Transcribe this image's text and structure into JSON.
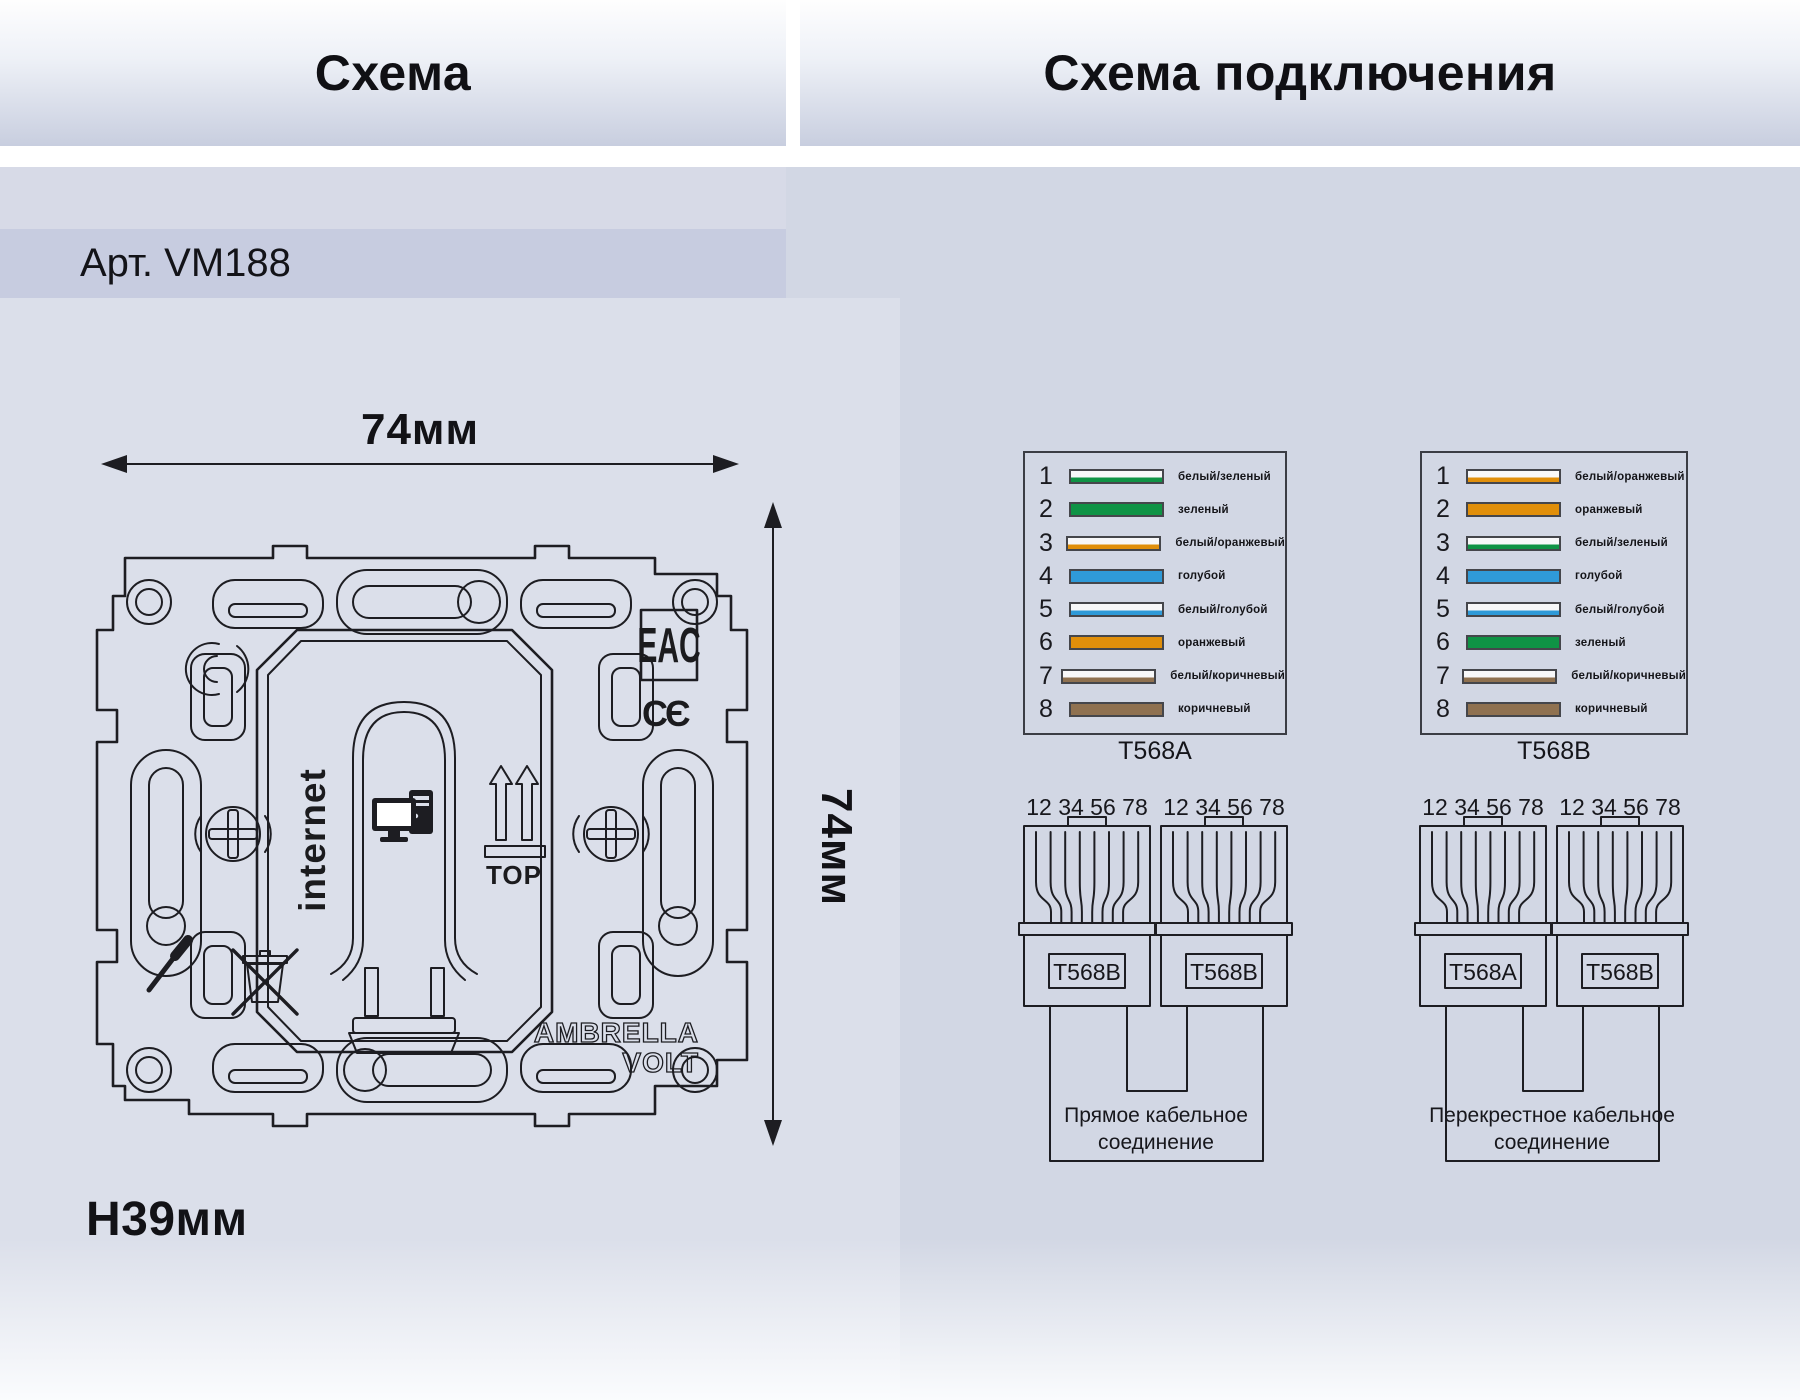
{
  "page": {
    "section_left_title": "Схема",
    "section_right_title": "Схема подключения",
    "article": "Арт. VM188"
  },
  "dimensions": {
    "width_label": "74мм",
    "height_label": "74мм",
    "depth_label": "H39мм"
  },
  "drawing": {
    "internet_label": "internet",
    "top_label": "TOP",
    "eac_mark": "EAC",
    "ce_mark": "CЄ",
    "brand_line1": "AMBRELLA",
    "brand_line2": "VOLT"
  },
  "colors": {
    "green": "#0f9345",
    "orange": "#e18f0a",
    "blue": "#2f9ad8",
    "brown": "#8f7150"
  },
  "wire_tables": [
    {
      "title": "T568A",
      "rows": [
        {
          "pin": "1",
          "label": "белый/зеленый",
          "style": "striped",
          "color": "#0f9345"
        },
        {
          "pin": "2",
          "label": "зеленый",
          "style": "solid",
          "color": "#0f9345"
        },
        {
          "pin": "3",
          "label": "белый/оранжевый",
          "style": "striped",
          "color": "#e18f0a"
        },
        {
          "pin": "4",
          "label": "голубой",
          "style": "solid",
          "color": "#2f9ad8"
        },
        {
          "pin": "5",
          "label": "белый/голубой",
          "style": "striped",
          "color": "#2f9ad8"
        },
        {
          "pin": "6",
          "label": "оранжевый",
          "style": "solid",
          "color": "#e18f0a"
        },
        {
          "pin": "7",
          "label": "белый/коричневый",
          "style": "striped",
          "color": "#8f7150"
        },
        {
          "pin": "8",
          "label": "коричневый",
          "style": "solid",
          "color": "#8f7150"
        }
      ]
    },
    {
      "title": "T568B",
      "rows": [
        {
          "pin": "1",
          "label": "белый/оранжевый",
          "style": "striped",
          "color": "#e18f0a"
        },
        {
          "pin": "2",
          "label": "оранжевый",
          "style": "solid",
          "color": "#e18f0a"
        },
        {
          "pin": "3",
          "label": "белый/зеленый",
          "style": "striped",
          "color": "#0f9345"
        },
        {
          "pin": "4",
          "label": "голубой",
          "style": "solid",
          "color": "#2f9ad8"
        },
        {
          "pin": "5",
          "label": "белый/голубой",
          "style": "striped",
          "color": "#2f9ad8"
        },
        {
          "pin": "6",
          "label": "зеленый",
          "style": "solid",
          "color": "#0f9345"
        },
        {
          "pin": "7",
          "label": "белый/коричневый",
          "style": "striped",
          "color": "#8f7150"
        },
        {
          "pin": "8",
          "label": "коричневый",
          "style": "solid",
          "color": "#8f7150"
        }
      ]
    }
  ],
  "connector_groups": [
    {
      "pins_label": "12 34 56 78",
      "connectors": [
        "T568B",
        "T568B"
      ],
      "caption": "Прямое кабельное соединение"
    },
    {
      "pins_label": "12 34 56 78",
      "connectors": [
        "T568A",
        "T568B"
      ],
      "caption": "Перекрестное кабельное соединение"
    }
  ]
}
